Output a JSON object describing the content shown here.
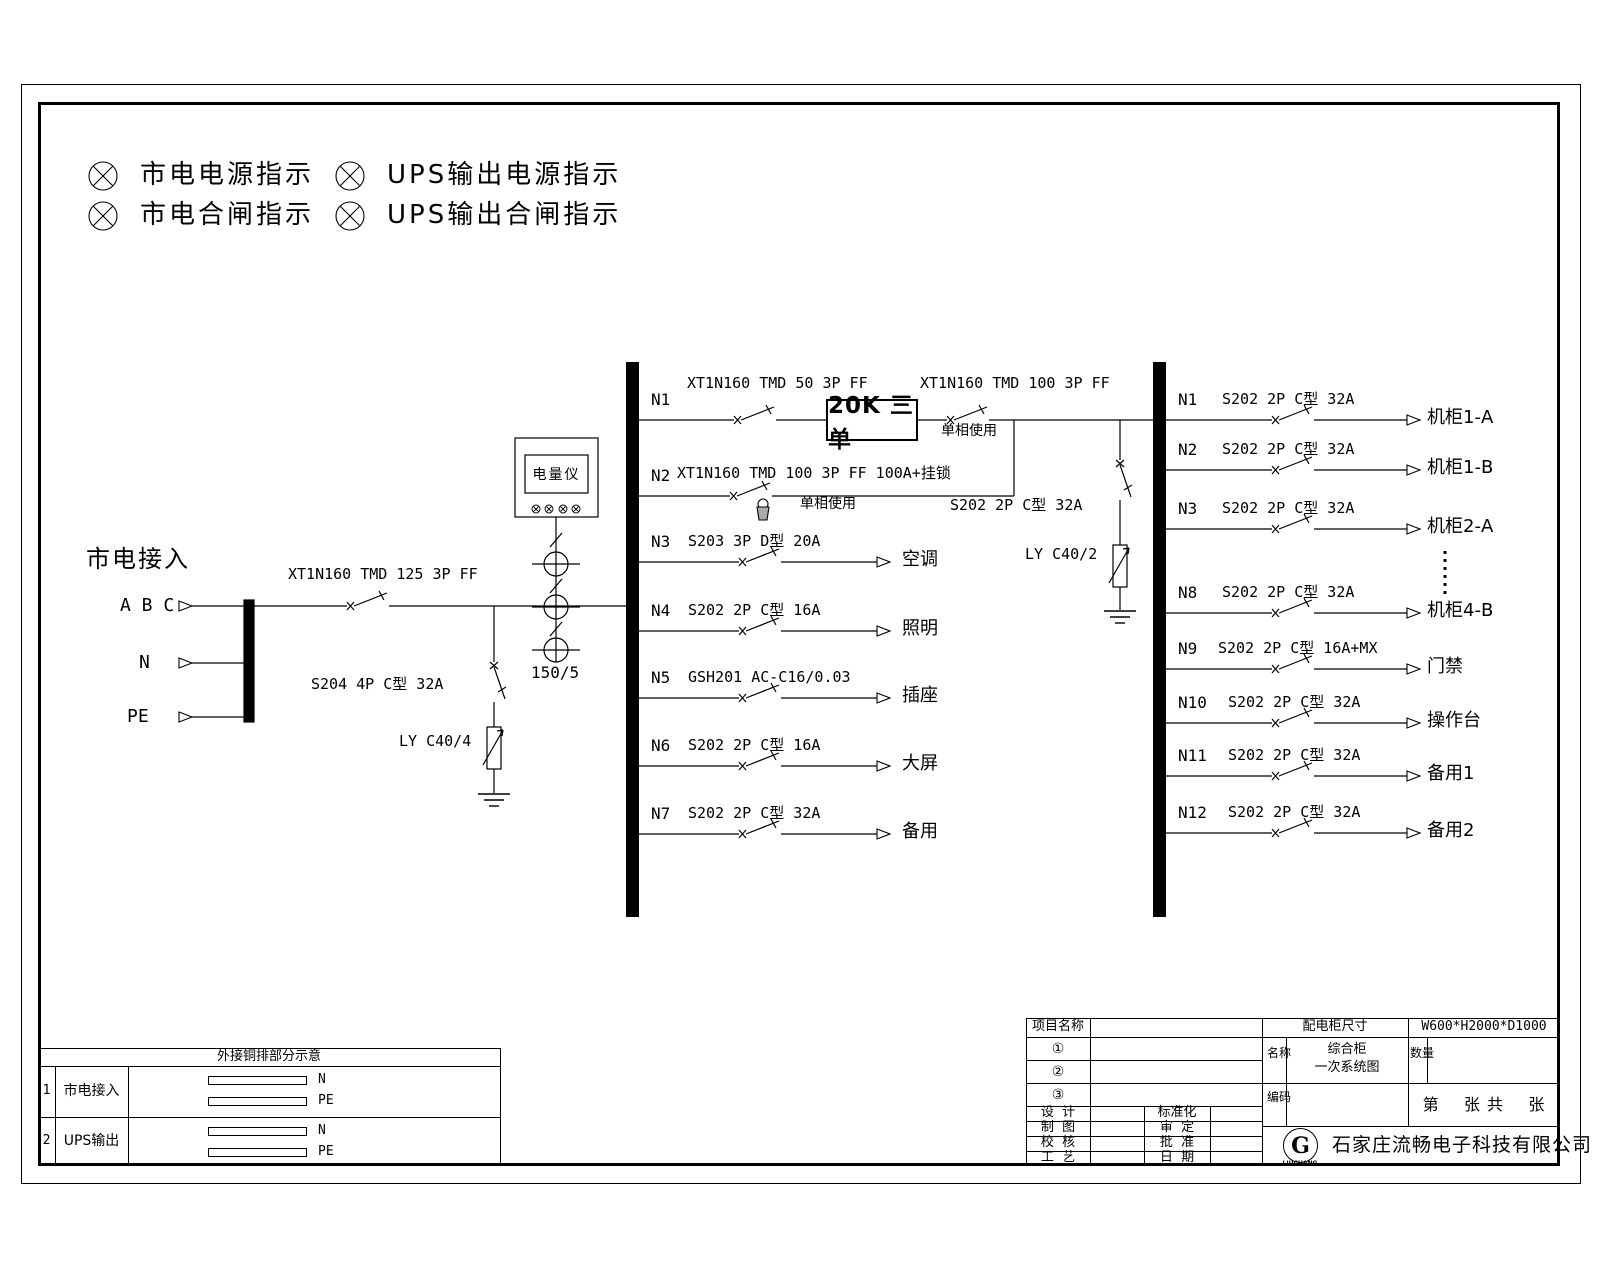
{
  "legend": {
    "items": [
      {
        "label": "市电电源指示"
      },
      {
        "label": "UPS输出电源指示"
      },
      {
        "label": "市电合闸指示"
      },
      {
        "label": "UPS输出合闸指示"
      }
    ]
  },
  "incoming": {
    "title": "市电接入",
    "phases": "A B C",
    "neutral": "N",
    "pe": "PE",
    "main_breaker": "XT1N160 TMD 125 3P FF",
    "spd_breaker": "S204 4P C型 32A",
    "spd": "LY C40/4",
    "meter": "电量仪",
    "ct_ratio": "150/5"
  },
  "ups": {
    "box_label": "20K 三单",
    "input_breaker": "XT1N160 TMD 50 3P FF",
    "output_breaker": "XT1N160 TMD 100 3P FF",
    "output_note": "单相使用",
    "bypass_breaker": "XT1N160 TMD 100 3P FF 100A+挂锁",
    "bypass_note": "单相使用",
    "output_spd_breaker": "S202 2P C型 32A",
    "output_spd": "LY C40/2"
  },
  "bus1": {
    "circuits": [
      {
        "id": "N1",
        "breaker": "",
        "load": ""
      },
      {
        "id": "N2",
        "breaker": "",
        "load": ""
      },
      {
        "id": "N3",
        "breaker": "S203 3P D型 20A",
        "load": "空调"
      },
      {
        "id": "N4",
        "breaker": "S202 2P C型 16A",
        "load": "照明"
      },
      {
        "id": "N5",
        "breaker": "GSH201 AC-C16/0.03",
        "load": "插座"
      },
      {
        "id": "N6",
        "breaker": "S202 2P C型 16A",
        "load": "大屏"
      },
      {
        "id": "N7",
        "breaker": "S202 2P C型 32A",
        "load": "备用"
      }
    ]
  },
  "bus2": {
    "circuits": [
      {
        "id": "N1",
        "breaker": "S202 2P C型 32A",
        "load": "机柜1-A"
      },
      {
        "id": "N2",
        "breaker": "S202 2P C型 32A",
        "load": "机柜1-B"
      },
      {
        "id": "N3",
        "breaker": "S202 2P C型 32A",
        "load": "机柜2-A"
      },
      {
        "id": "N8",
        "breaker": "S202 2P C型 32A",
        "load": "机柜4-B"
      },
      {
        "id": "N9",
        "breaker": "S202 2P C型 16A+MX",
        "load": "门禁"
      },
      {
        "id": "N10",
        "breaker": "S202 2P C型 32A",
        "load": "操作台"
      },
      {
        "id": "N11",
        "breaker": "S202 2P C型 32A",
        "load": "备用1"
      },
      {
        "id": "N12",
        "breaker": "S202 2P C型 32A",
        "load": "备用2"
      }
    ]
  },
  "busbar_table": {
    "title": "外接铜排部分示意",
    "rows": [
      {
        "no": "1",
        "name": "市电接入",
        "bar1": "N",
        "bar2": "PE"
      },
      {
        "no": "2",
        "name": "UPS输出",
        "bar1": "N",
        "bar2": "PE"
      }
    ]
  },
  "title_block": {
    "project_label": "项目名称",
    "rev1": "①",
    "rev2": "②",
    "rev3": "③",
    "design": "设  计",
    "draft": "制  图",
    "check": "校  核",
    "process": "工  艺",
    "standard": "标准化",
    "review": "审  定",
    "approve": "批  准",
    "date": "日  期",
    "cabinet_size_label": "配电柜尺寸",
    "cabinet_size": "W600*H2000*D1000",
    "name_label": "名称",
    "name_value_1": "综合柜",
    "name_value_2": "一次系统图",
    "qty_label": "数量",
    "code_label": "编码",
    "sheet": "第    张 共    张",
    "company": "石家庄流畅电子科技有限公司",
    "logo_letter": "G",
    "logo_sub": "LIUCHANG"
  }
}
